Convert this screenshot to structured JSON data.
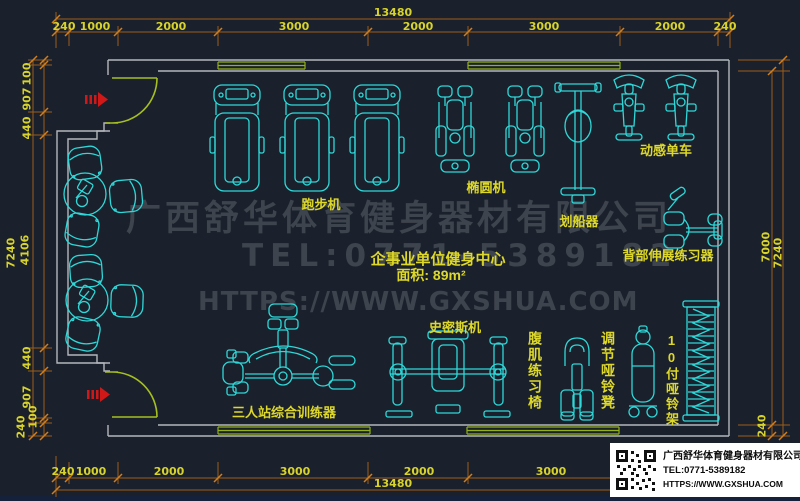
{
  "watermark": {
    "line1": "广西舒华体育健身器材有限公司",
    "line2": "TEL:0771-5389182",
    "line3": "HTTPS://WWW.GXSHUA.COM"
  },
  "room": {
    "name": "企事业单位健身中心",
    "area": "面积: 89m²"
  },
  "labels": {
    "treadmill": "跑步机",
    "elliptical": "椭圆机",
    "rower": "划船器",
    "spin_bike": "动感单车",
    "back_extension": "背部伸展练习器",
    "smith_machine": "史密斯机",
    "ab_bench": "腹肌练习椅",
    "adj_dumbbell_bench": "调节哑铃凳",
    "dumbbell_rack": "10付哑铃架",
    "multi_station": "三人站综合训练器"
  },
  "dims": {
    "top": {
      "total": "13480",
      "segments": [
        "240",
        "1000",
        "2000",
        "3000",
        "2000",
        "3000",
        "2000",
        "240"
      ]
    },
    "bottom": {
      "total": "13480",
      "segments": [
        "240",
        "1000",
        "2000",
        "3000",
        "2000",
        "3000"
      ]
    },
    "left": {
      "total": "7240",
      "segments": [
        "100",
        "907",
        "440",
        "4106",
        "440",
        "907",
        "100",
        "240"
      ]
    },
    "right": {
      "inner_height": "7000",
      "total": "7240",
      "bottom_wall": "240"
    }
  },
  "titleblock": {
    "company": "广西舒华体育健身器材有限公司",
    "tel": "TEL:0771-5389182",
    "website": "HTTPS://WWW.GXSHUA.COM"
  },
  "colors": {
    "background": "#1b212c",
    "linework": "#2ed8d8",
    "wall": "#b3b7bc",
    "door": "#a6c01f",
    "dimension_line": "#9c5c18",
    "dimension_text": "#d8d32b",
    "entrance_arrow": "#d01818",
    "watermark": "#3e444d"
  }
}
